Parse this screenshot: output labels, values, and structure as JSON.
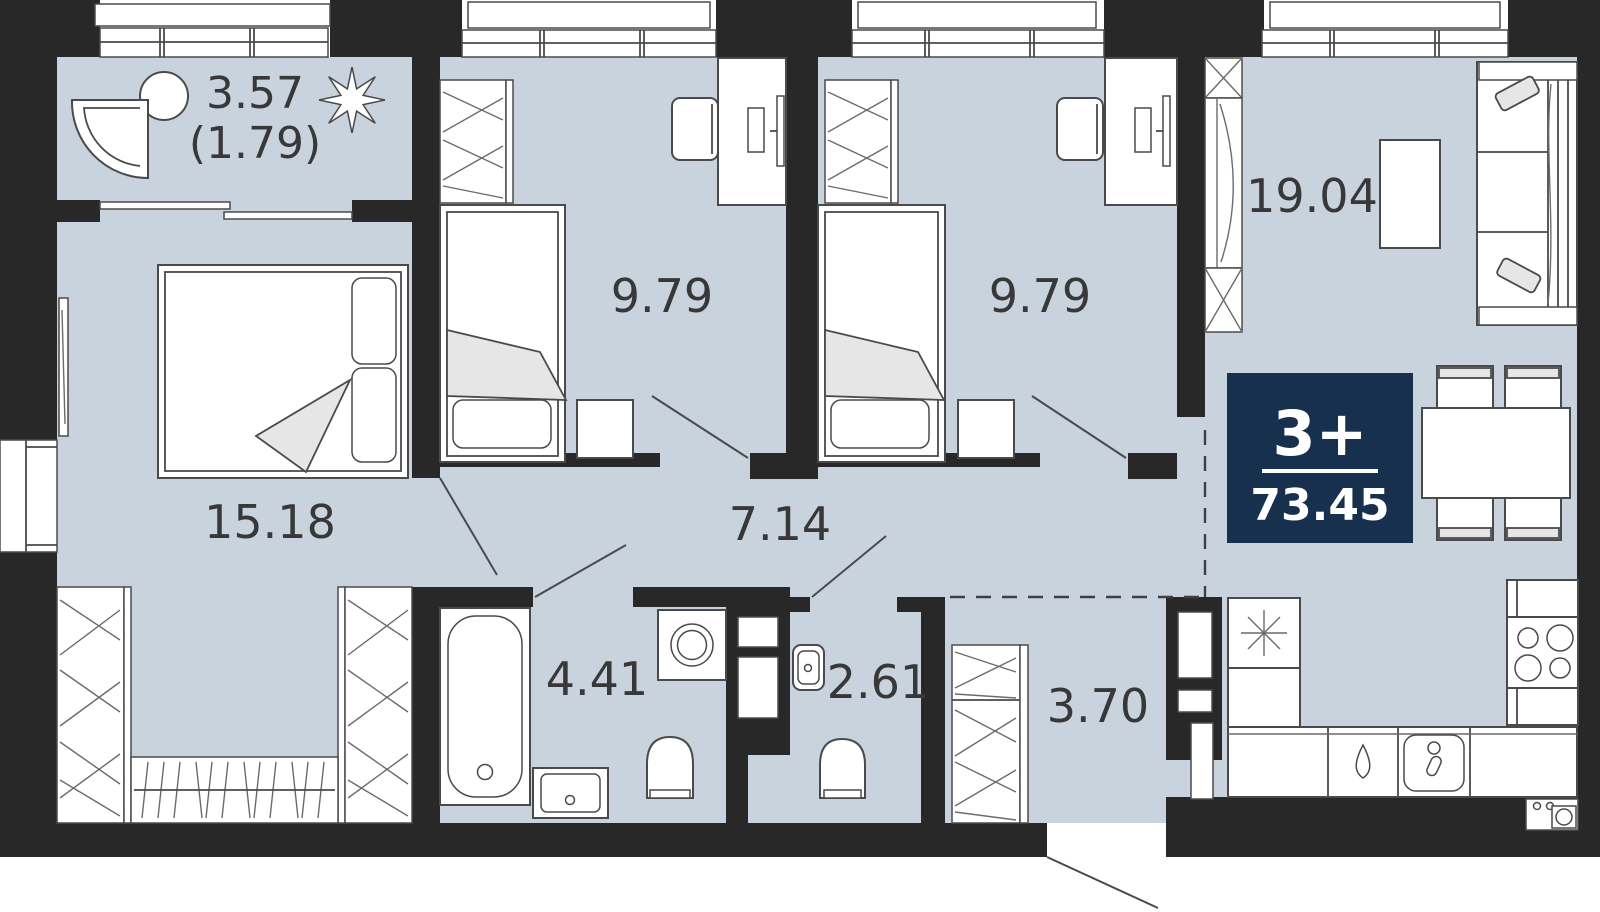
{
  "plan": {
    "type": "apartment-floor-plan",
    "badge": {
      "rooms_label": "3+",
      "total_area": "73.45",
      "bg_color": "#16304d",
      "text_color": "#ffffff"
    },
    "rooms": [
      {
        "id": "balcony",
        "area": "3.57",
        "area_secondary": "(1.79)"
      },
      {
        "id": "master-bedroom",
        "area": "15.18"
      },
      {
        "id": "bedroom-1",
        "area": "9.79"
      },
      {
        "id": "bedroom-2",
        "area": "9.79"
      },
      {
        "id": "kitchen-living",
        "area": "19.04"
      },
      {
        "id": "hallway",
        "area": "7.14"
      },
      {
        "id": "bathroom",
        "area": "4.41"
      },
      {
        "id": "wc",
        "area": "2.61"
      },
      {
        "id": "hall",
        "area": "3.70"
      }
    ],
    "colors": {
      "background": "#ffffff",
      "floor": "#c9d3de",
      "wall": "#282828",
      "furniture_stroke": "#4a4a4a",
      "label": "#383838",
      "badge_bg": "#16304d"
    }
  }
}
